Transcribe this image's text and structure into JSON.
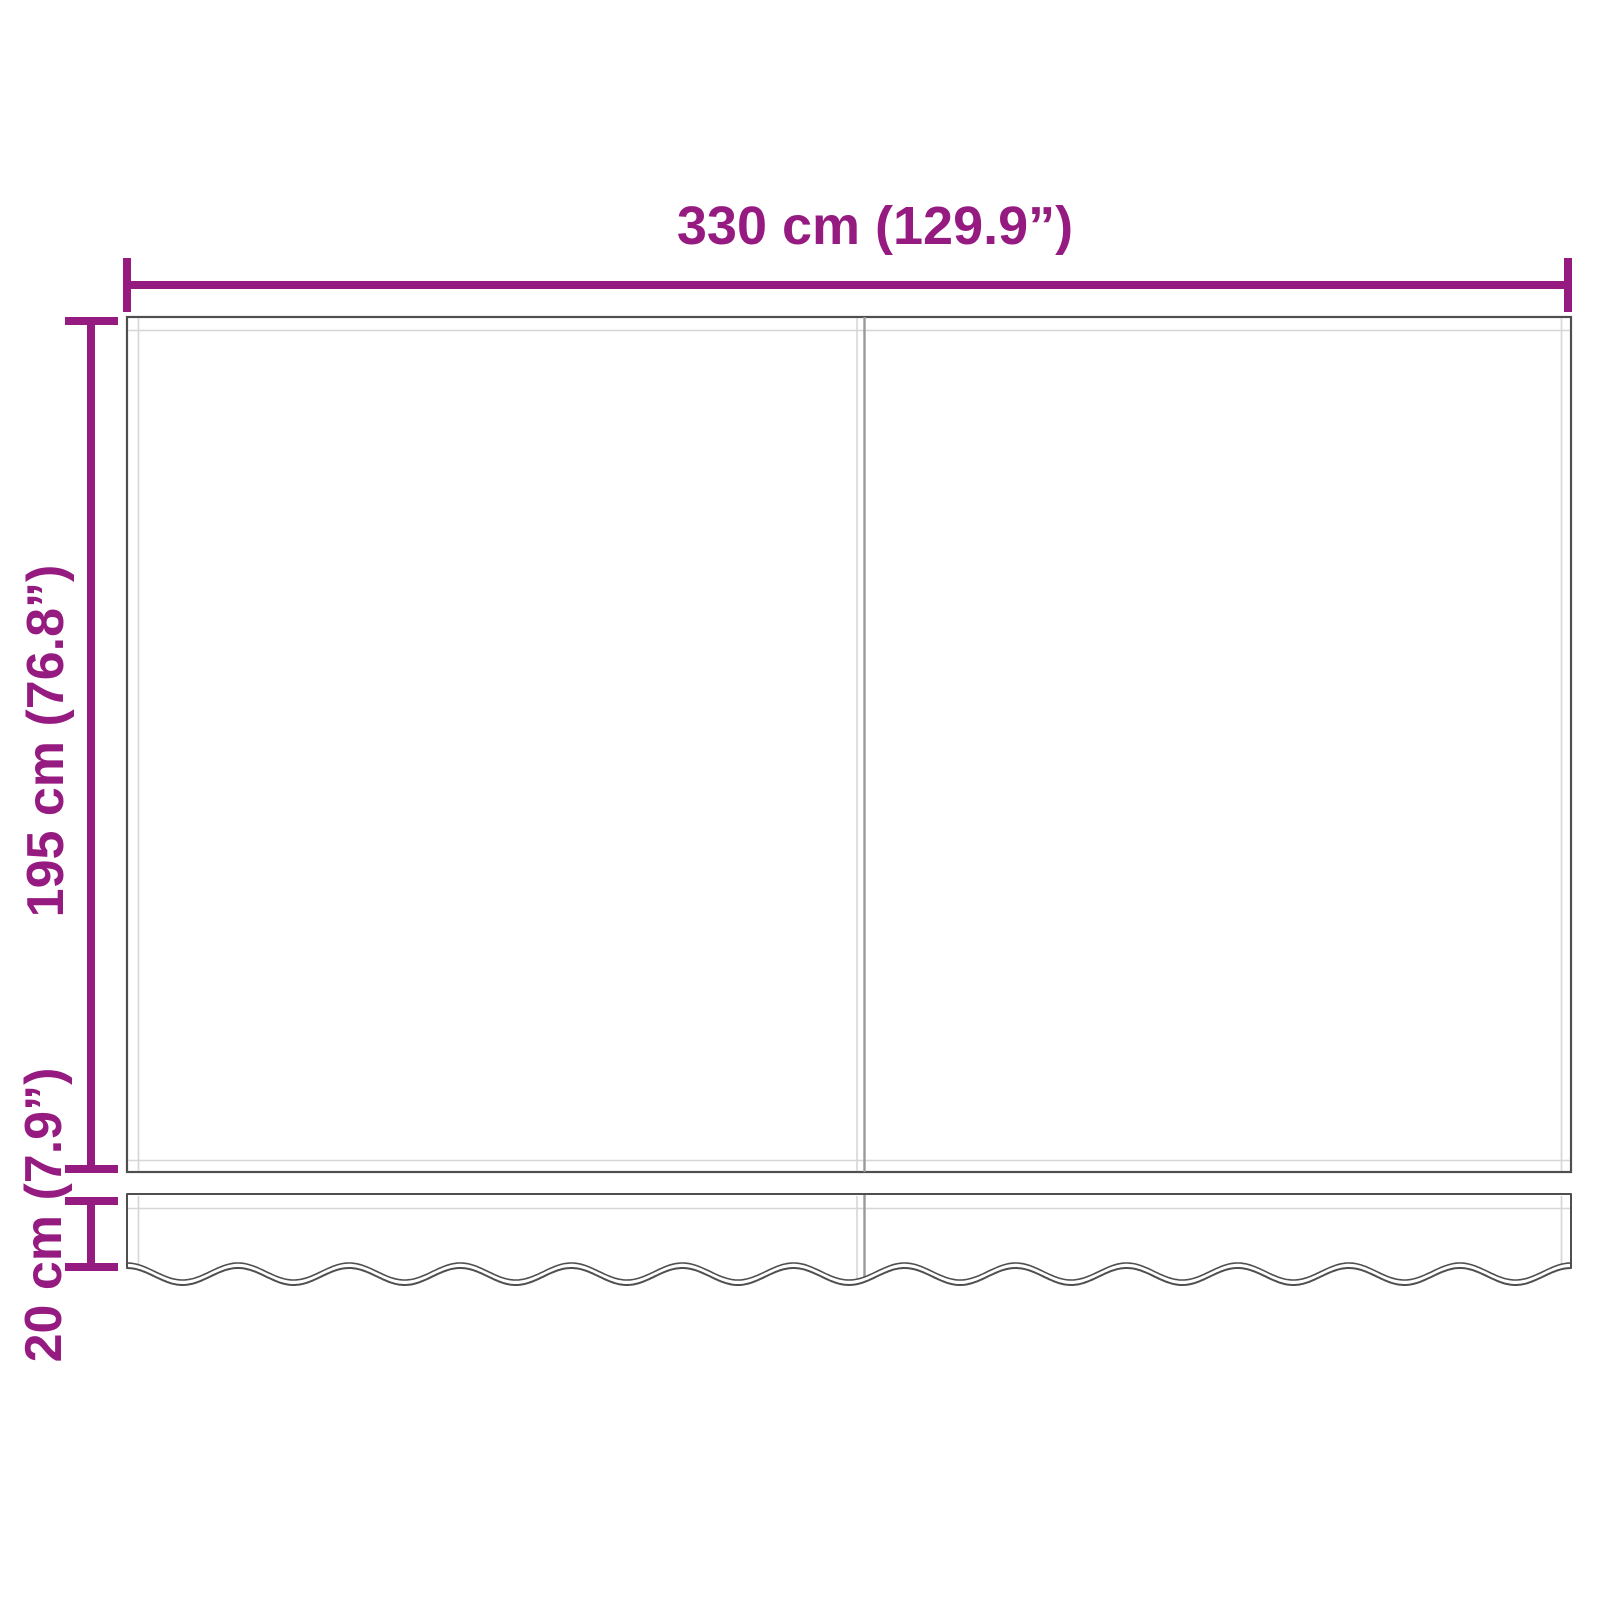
{
  "diagram": {
    "type": "awning-fabric-dimension-drawing",
    "dimensions": {
      "width": {
        "label": "330 cm (129.9”)",
        "value_cm": 330,
        "value_inch": 129.9
      },
      "height": {
        "label": "195 cm (76.8”)",
        "value_cm": 195,
        "value_inch": 76.8
      },
      "valance": {
        "label": "20 cm (7.9”)",
        "value_cm": 20,
        "value_inch": 7.9
      }
    }
  },
  "colors": {
    "dimension": "#951b81",
    "outline": "#4f4f4f",
    "seam": "#9a9a9a",
    "hem": "#d6d6d6",
    "background": "#ffffff"
  }
}
